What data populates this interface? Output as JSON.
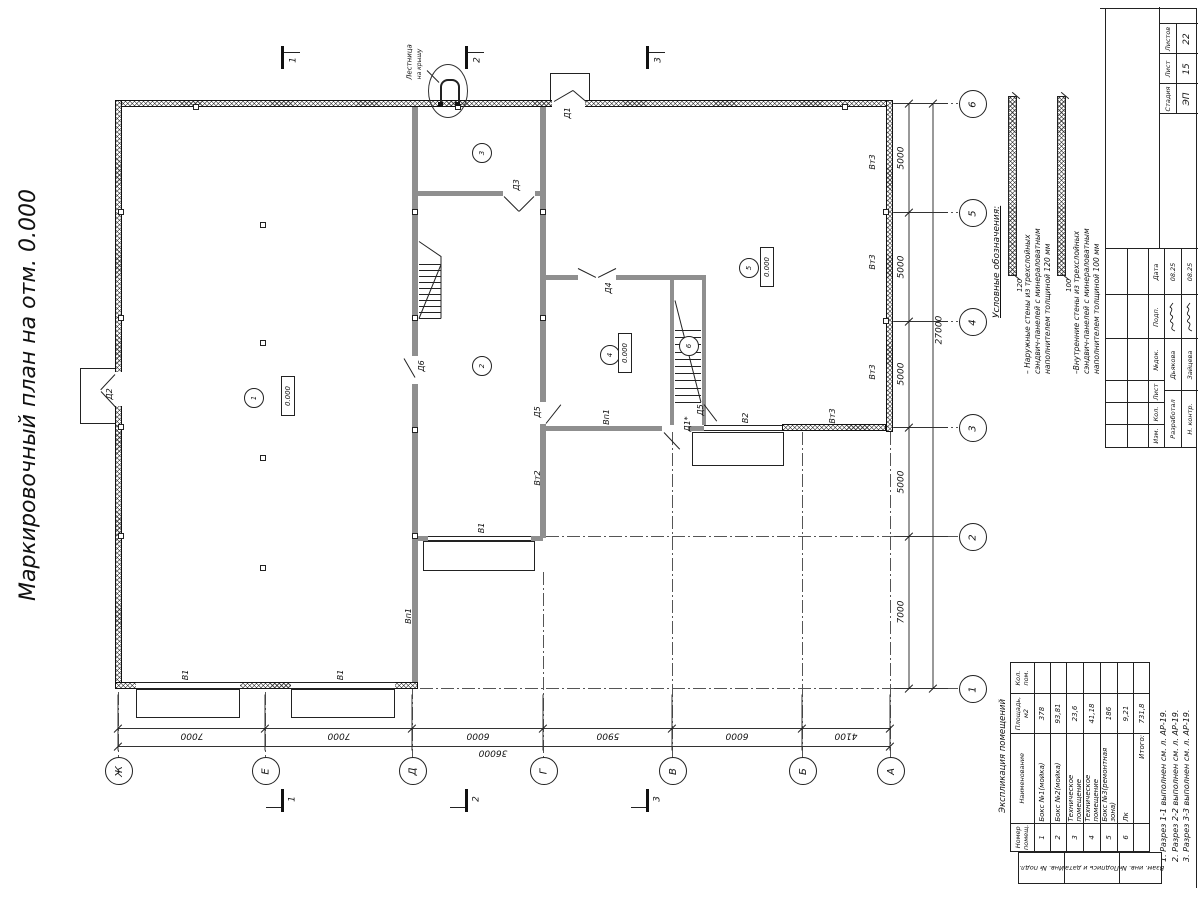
{
  "sheet": {
    "title": "Маркировочный план на отм. 0.000",
    "notes": [
      "1. Разрез 1-1 выполнен см. л. АР-19.",
      "2. Разрез 2-2 выполнен см. л. АР-19.",
      "3. Разрез 3-3 выполнен см. л. АР-19."
    ]
  },
  "legend": {
    "title": "Условные обозначения:",
    "items": [
      {
        "dim": "120",
        "text": "– Наружные стены из трехслойных\nсэндвич-панелей с минераловатным\nнаполнителем толщиной 120 мм"
      },
      {
        "dim": "100",
        "text": "–Внутренние стены из трехслойных\nсэндвич-панелей с минераловатным\nнаполнителем толщиной 100 мм"
      }
    ]
  },
  "room_table": {
    "title": "Экспликация помещений",
    "headers": [
      "Номер\nпомещ.",
      "Наименование",
      "Площадь,\nм2",
      "Кол.\nпом."
    ],
    "rows": [
      [
        "1",
        "Бокс №1(мойка)",
        "378",
        ""
      ],
      [
        "2",
        "Бокс №2(мойка)",
        "93,81",
        ""
      ],
      [
        "3",
        "Техническое помещение",
        "23,6",
        ""
      ],
      [
        "4",
        "Техническое помещение",
        "41,18",
        ""
      ],
      [
        "5",
        "Бокс №3(ремонтная зона)",
        "186",
        ""
      ],
      [
        "6",
        "Лк",
        "9,21",
        ""
      ]
    ],
    "total_label": "Итого:",
    "total_value": "731,8"
  },
  "title_block": {
    "columns": [
      "Изм.",
      "Кол.",
      "Лист",
      "№док.",
      "Подп.",
      "Дата"
    ],
    "sign_rows": [
      {
        "role": "Разработал",
        "name": "Дьякова",
        "date": "08.25"
      },
      {
        "role": "Н. контр.",
        "name": "Зайцева",
        "date": "08.25"
      }
    ],
    "stage_label": "Стадия",
    "sheet_label": "Лист",
    "sheets_label": "Листов",
    "stage_value": "ЭП",
    "sheet_value": "15",
    "sheets_value": "22"
  },
  "side_strips": [
    "Инв. № подл.",
    "Подпись и дата",
    "Взам. инв. №"
  ],
  "plan": {
    "axis_letters": [
      "Ж",
      "Е",
      "Д",
      "Г",
      "В",
      "Б",
      "А"
    ],
    "axis_numbers": [
      "6",
      "5",
      "4",
      "3",
      "2",
      "1"
    ],
    "dims_bottom": [
      "7000",
      "7000",
      "6000",
      "5900",
      "6000",
      "4100"
    ],
    "dim_bottom_total": "36000",
    "dims_right": [
      "5000",
      "5000",
      "5000",
      "5000",
      "7000"
    ],
    "dim_right_total": "27000",
    "section_labels": [
      "1",
      "2",
      "3"
    ],
    "elevation_value": "0.000",
    "room_circles": [
      {
        "n": "1",
        "x": 253,
        "y": 397
      },
      {
        "n": "2",
        "x": 481,
        "y": 365
      },
      {
        "n": "3",
        "x": 481,
        "y": 152
      },
      {
        "n": "4",
        "x": 609,
        "y": 354
      },
      {
        "n": "5",
        "x": 748,
        "y": 267
      },
      {
        "n": "6",
        "x": 688,
        "y": 345
      }
    ],
    "elevation_marks": [
      {
        "x": 288,
        "y": 396
      },
      {
        "x": 625,
        "y": 353
      },
      {
        "x": 767,
        "y": 267
      }
    ],
    "labels": [
      {
        "t": "Д1",
        "x": 568,
        "y": 113
      },
      {
        "t": "Д2",
        "x": 110,
        "y": 394
      },
      {
        "t": "Д3",
        "x": 517,
        "y": 185
      },
      {
        "t": "Д4",
        "x": 609,
        "y": 288
      },
      {
        "t": "Д5",
        "x": 538,
        "y": 412
      },
      {
        "t": "Д5",
        "x": 701,
        "y": 410
      },
      {
        "t": "Д6",
        "x": 422,
        "y": 366
      },
      {
        "t": "Д1*",
        "x": 688,
        "y": 424
      },
      {
        "t": "В1",
        "x": 186,
        "y": 675
      },
      {
        "t": "В1",
        "x": 341,
        "y": 675
      },
      {
        "t": "В1",
        "x": 482,
        "y": 528
      },
      {
        "t": "В2",
        "x": 746,
        "y": 418
      },
      {
        "t": "Вп1",
        "x": 607,
        "y": 417
      },
      {
        "t": "Вп1",
        "x": 409,
        "y": 616
      },
      {
        "t": "Вт2",
        "x": 538,
        "y": 478
      },
      {
        "t": "Вт3",
        "x": 873,
        "y": 162
      },
      {
        "t": "Вт3",
        "x": 873,
        "y": 262
      },
      {
        "t": "Вт3",
        "x": 873,
        "y": 372
      },
      {
        "t": "Вт3",
        "x": 833,
        "y": 416
      }
    ],
    "ladder_label": [
      "Лестница",
      "на крышу"
    ]
  }
}
